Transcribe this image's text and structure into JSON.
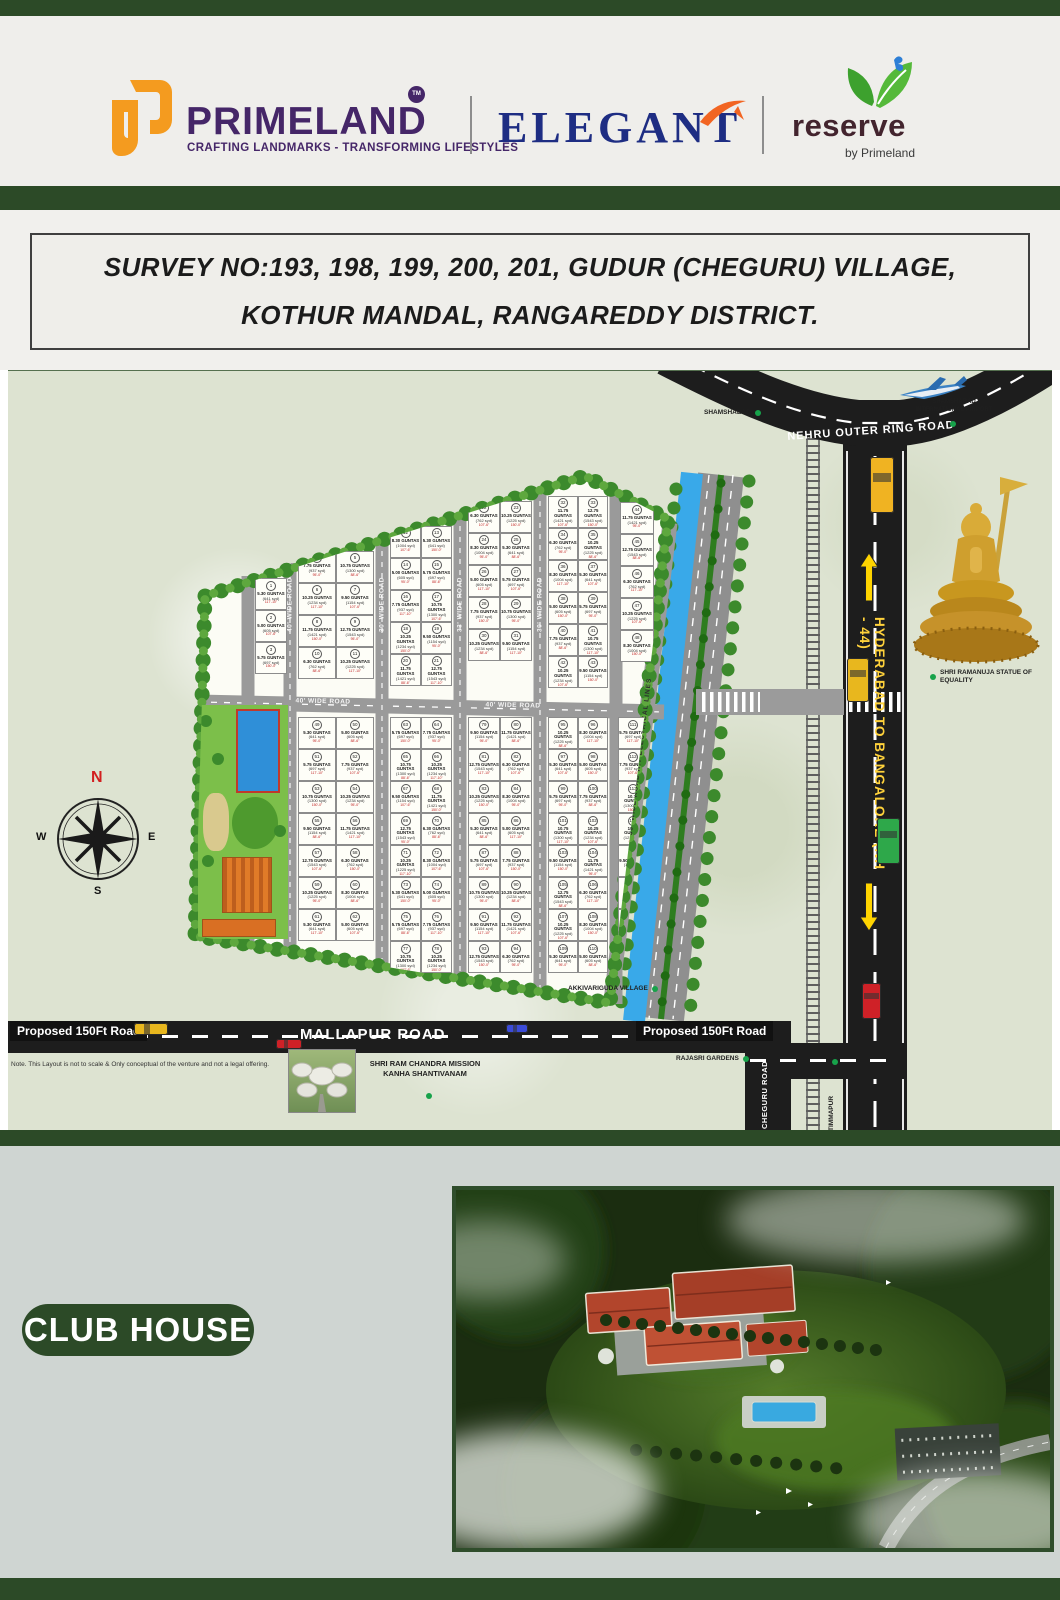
{
  "header": {
    "primeland": {
      "name": "PRIMELAND",
      "tm": "TM",
      "tagline": "CRAFTING LANDMARKS - TRANSFORMING LIFESTYLES"
    },
    "elegant": {
      "name": "ELEGANT"
    },
    "reserve": {
      "name": "reserve",
      "byline": "by Primeland"
    }
  },
  "survey": {
    "line1": "SURVEY NO:193, 198, 199, 200, 201, GUDUR (CHEGURU) VILLAGE,",
    "line2": "KOTHUR MANDAL, RANGAREDDY DISTRICT."
  },
  "map": {
    "roads": {
      "orr": "NEHRU OUTER RING ROAD",
      "nh44": "HYDERABAD TO BANGALORE  (NH - 44)",
      "mallapur": "MALLAPUR ROAD",
      "proposed_left": "Proposed 150Ft Road",
      "proposed_right": "Proposed 150Ft Road",
      "cheguru": "CHEGURU ROAD",
      "site_h_left": "40' WIDE ROAD",
      "site_h_right": "40' WIDE ROAD",
      "site_v1": "40' WIDE ROAD",
      "site_v2": "30' WIDE ROAD",
      "site_v3": "33' WIDE ROAD",
      "site_v4": "30' WIDE ROAD",
      "ht_lines": "30' WIDE ROAD  H.T ELECTRICAL LINES"
    },
    "landmarks": {
      "shamshabad": "SHAMSHABAD",
      "airport": "SHAMSHABAD INTERNATIONAL AIRPORT",
      "statue": "SHRI RAMANUJA STATUE OF EQUALITY",
      "village": "AKKIVARIGUDA VILLAGE",
      "gardens": "RAJASRI GARDENS",
      "timmapur": "TIMMAPUR",
      "mission": "SHRI RAM CHANDRA MISSION KANHA SHANTIVANAM"
    },
    "compass": {
      "n": "N",
      "e": "E",
      "s": "S",
      "w": "W"
    },
    "note": "Note. This Layout is not to scale & Only conceptual of the venture and not a legal offering.",
    "plots": {
      "unit": "GUNTAS",
      "samples": [
        {
          "guntas": "5.30 GUNTAS",
          "syd": "(641 syd)"
        },
        {
          "guntas": "5.00 GUNTAS",
          "syd": "(605 syd)"
        },
        {
          "guntas": "5.75 GUNTAS",
          "syd": "(697 syd)"
        },
        {
          "guntas": "7.75 GUNTAS",
          "syd": "(937 syd)"
        },
        {
          "guntas": "10.75 GUNTAS",
          "syd": "(1300 syd)"
        },
        {
          "guntas": "10.25 GUNTAS",
          "syd": "(1234 syd)"
        },
        {
          "guntas": "9.50 GUNTAS",
          "syd": "(1154 syd)"
        },
        {
          "guntas": "11.75 GUNTAS",
          "syd": "(1421 syd)"
        },
        {
          "guntas": "12.75 GUNTAS",
          "syd": "(1543 syd)"
        },
        {
          "guntas": "6.30 GUNTAS",
          "syd": "(762 syd)"
        },
        {
          "guntas": "10.25 GUNTAS",
          "syd": "(1225 syd)"
        },
        {
          "guntas": "8.30 GUNTAS",
          "syd": "(1004 syd)"
        }
      ],
      "dims": [
        "117'-10\"",
        "107'-6\"",
        "150'-0\"",
        "95'-0\"",
        "88'-6\""
      ]
    }
  },
  "clubhouse": {
    "label": "CLUB HOUSE"
  },
  "colors": {
    "brand_orange": "#F49B1F",
    "brand_purple": "#452668",
    "elegant_navy": "#1E2D83",
    "reserve_brown": "#43242E",
    "banner_green": "#2C4A27",
    "highway_black": "#1D1D1D",
    "canal_blue": "#39A9E9",
    "marker_green": "#17A24A",
    "accent_yellow": "#FFD23B"
  }
}
